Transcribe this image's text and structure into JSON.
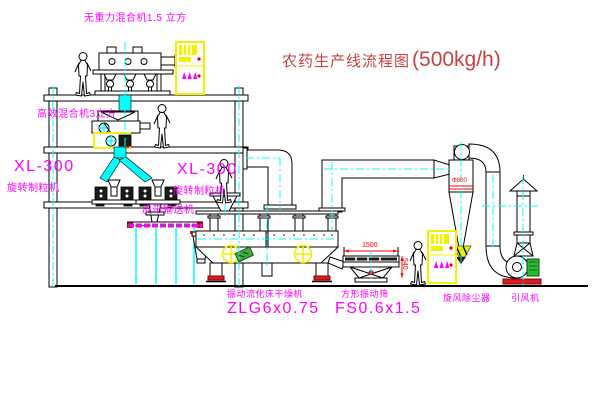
{
  "title": {
    "text": "农药生产线流程图",
    "capacity": "(500kg/h)"
  },
  "labels": {
    "top_mixer": "无重力混合机1.5 立方",
    "second_mixer": "高效混合机3立方",
    "granulator_left_model": "XL-300",
    "granulator_left_name": "旋转制粒机",
    "granulator_center_model": "XL-300",
    "granulator_center_name": "旋转制粒机",
    "belt_conveyor": "皮带输送机",
    "dryer_name": "振动流化床干燥机",
    "dryer_model": "ZLG6x0.75",
    "sieve_name": "方形振动筛",
    "sieve_model": "FS0.6x1.5",
    "cyclone": "旋风除尘器",
    "fan": "引风机"
  },
  "dimensions": {
    "sieve_width": "1500",
    "sieve_height": "540",
    "cyclone_band": "Φ800"
  },
  "colors": {
    "label_magenta": "#FF00FF",
    "title_red": "#C84040",
    "dimension_red": "#FF0000",
    "highlight_yellow": "#F2F200",
    "centerline_cyan": "#00FFFF",
    "line_black": "#000000",
    "motor_green": "#2DB82D",
    "background": "#FFFFFF"
  }
}
